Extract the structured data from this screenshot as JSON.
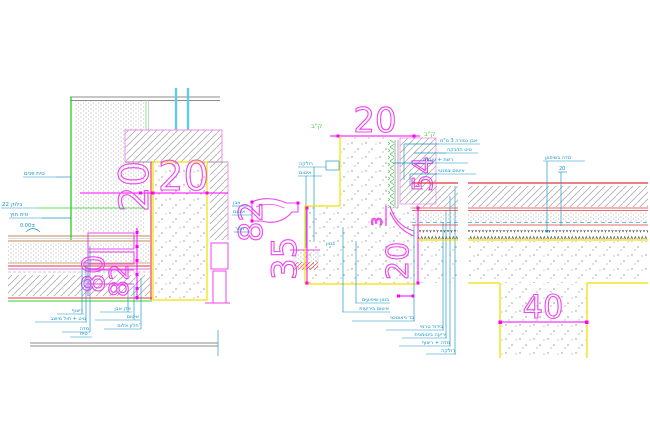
{
  "drawing": {
    "type": "cad-architectural-detail",
    "background": "#ffffff",
    "colors": {
      "dimension_magenta": "#ff00ff",
      "label_cyan": "#1193c4",
      "pipe_lightblue": "#62c9e6",
      "finish_green": "#2ed52e",
      "concrete_outline_yellow": "#f0e000",
      "waterproofing_red": "#e2383d",
      "wood_tan": "#b98b57",
      "hatch_gray": "#adadad"
    },
    "left_detail": {
      "dim_width_h": "20",
      "dim_width_v": "20",
      "dim_sill_a": "80",
      "dim_sill_b": "82",
      "lbl_plaster_in": "טיח פנים",
      "lbl_block": "בלוק 22",
      "lbl_plaster_out": "טיח חוץ",
      "lbl_level": "0.00±",
      "floor_row1": "ריצוף",
      "floor_row2": "טיט + חול מיוצב",
      "floor_row3": "מדה",
      "sill_row1": "אדן אבן",
      "sill_row2": "איטום",
      "sill_row3": "חלון אלומ'",
      "lbl_bottom": "טיח"
    },
    "middle_detail": {
      "dim_top": "20",
      "dim_left_v": "82",
      "dim_height": "35",
      "dim_right_v": "20",
      "dim_small": "3",
      "dim_stone": "54",
      "green_mark_1": "ק\"ב",
      "green_mark_2": "ק\"ב",
      "top_lbl1": "רולקה",
      "top_lbl2": "איטום",
      "left_lbl1": "אבן",
      "left_lbl2": "איטום",
      "left_lbl3": "תפר",
      "concrete_lbl": "בטון",
      "right_lbl1": "אבן נסורה 3 ס\"מ",
      "right_lbl2": "טיט הדבקה",
      "right_lbl3": "רשת + עוגנים",
      "right_lbl4": "איטום צמנטי",
      "stack": [
        "בטון שיפועים",
        "איטום ביריעות",
        "בד גיאוטכני",
        "בידוד טרמי",
        "יריעה ביטומנית",
        "מדה + ריצוף",
        "רולקה"
      ]
    },
    "right_detail": {
      "dim_beam": "40",
      "top_lbl1": "מדה בשיפוע",
      "top_lbl2": "20"
    }
  }
}
